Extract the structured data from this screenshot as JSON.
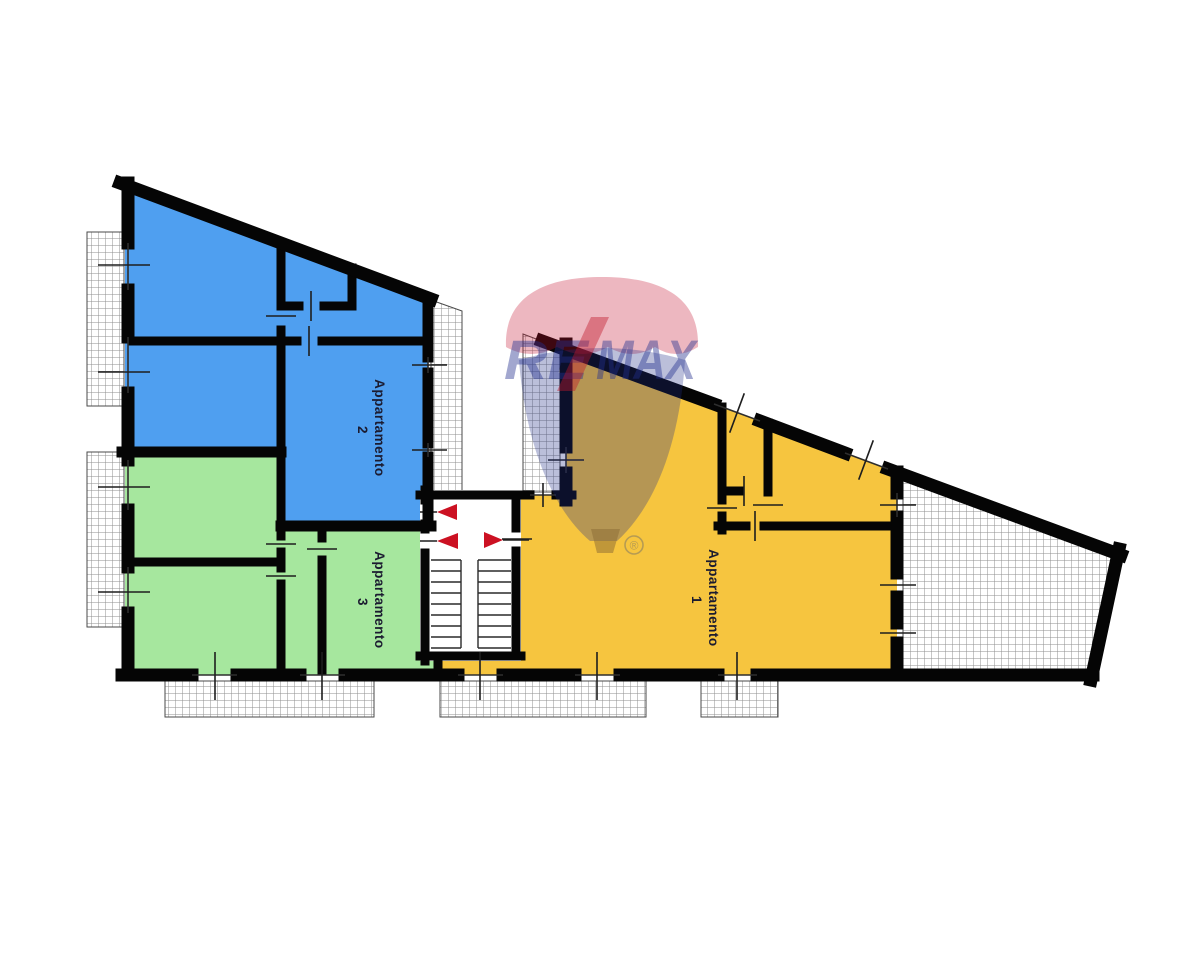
{
  "plan": {
    "apartments": [
      {
        "name": "Appartamento",
        "number": "1",
        "fill": "#F6C53F",
        "position": "right"
      },
      {
        "name": "Appartamento",
        "number": "2",
        "fill": "#4F9FF0",
        "position": "top-left"
      },
      {
        "name": "Appartamento",
        "number": "3",
        "fill": "#A6E79E",
        "position": "bottom-left"
      }
    ],
    "colors": {
      "walls": "#050505",
      "stair_arrows": "#CC1122",
      "hatch_lines": "#8F8F8F",
      "background": "#FFFFFF"
    }
  },
  "watermark": {
    "re": "RE",
    "slash": "/",
    "max": "MAX",
    "registered": "®",
    "canopy_color": "#C41230",
    "bulb_color": "#1D2C86",
    "basket_color": "#8A6A33",
    "text_color": "#23308F",
    "slash_color": "#C2172C"
  }
}
